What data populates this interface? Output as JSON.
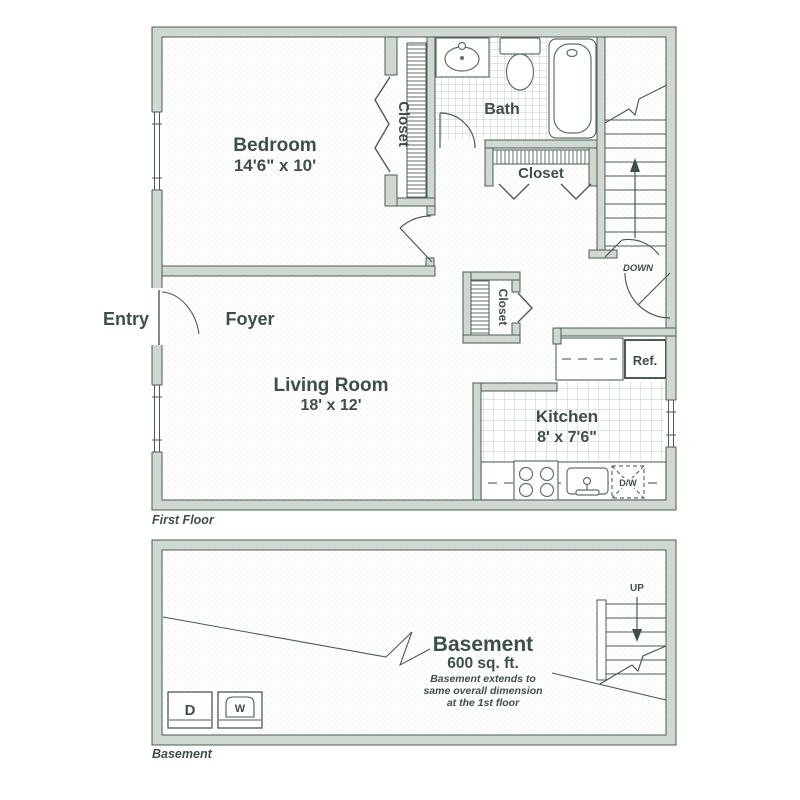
{
  "palette": {
    "line": "#4a5c53",
    "text": "#3d5047",
    "wall_fill": "#cfd9d2",
    "tile_line": "#c2cec7",
    "fixture_line": "#5f7268",
    "background": "#ffffff"
  },
  "first_floor": {
    "caption": "First Floor",
    "rooms": {
      "bedroom": {
        "label": "Bedroom",
        "dimensions": "14'6\" x 10'"
      },
      "living_room": {
        "label": "Living Room",
        "dimensions": "18' x 12'"
      },
      "kitchen": {
        "label": "Kitchen",
        "dimensions": "8' x 7'6\""
      },
      "bath": {
        "label": "Bath"
      },
      "foyer": {
        "label": "Foyer"
      },
      "entry": {
        "label": "Entry"
      },
      "bedroom_closet": {
        "label": "Closet"
      },
      "hall_closet": {
        "label": "Closet"
      },
      "foyer_closet": {
        "label": "Closet"
      }
    },
    "fixtures": {
      "refrigerator": "Ref.",
      "dishwasher": "D/W"
    },
    "stairs": {
      "direction_label": "DOWN"
    }
  },
  "basement": {
    "caption": "Basement",
    "title": "Basement",
    "area": "600 sq. ft.",
    "note_lines": [
      "Basement extends to",
      "same overall dimension",
      "at the 1st floor"
    ],
    "appliances": {
      "dryer": "D",
      "washer": "W"
    },
    "stairs": {
      "direction_label": "UP"
    }
  }
}
